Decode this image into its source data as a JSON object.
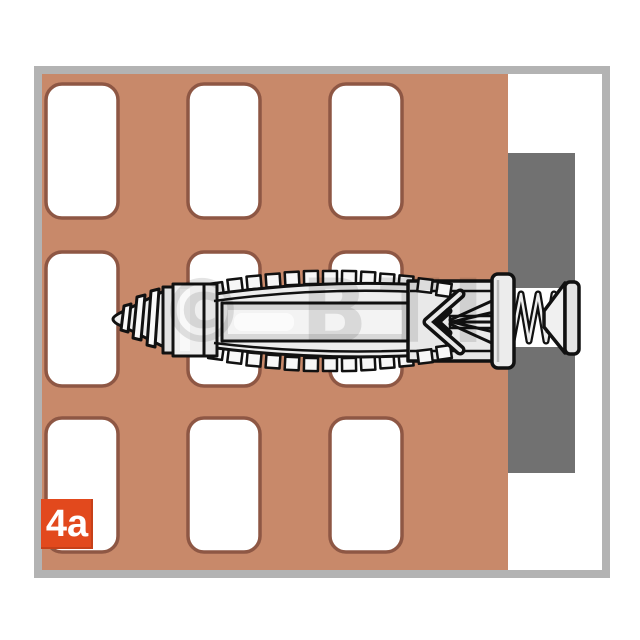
{
  "step_label": {
    "text": "4a"
  },
  "watermark": {
    "text": "© BTI"
  },
  "colors": {
    "page_bg": "#ffffff",
    "frame": "#b3b3b3",
    "wall": "#c8896a",
    "cavity_fill": "#ffffff",
    "cavity_outline": "#8e5744",
    "fixture": "#717171",
    "fixture_hole": "#ffffff",
    "outline": "#111111",
    "plastic_fill": "#ededed",
    "label_bg": "#e2491d",
    "label_text": "#ffffff",
    "watermark_color": "#000000"
  }
}
